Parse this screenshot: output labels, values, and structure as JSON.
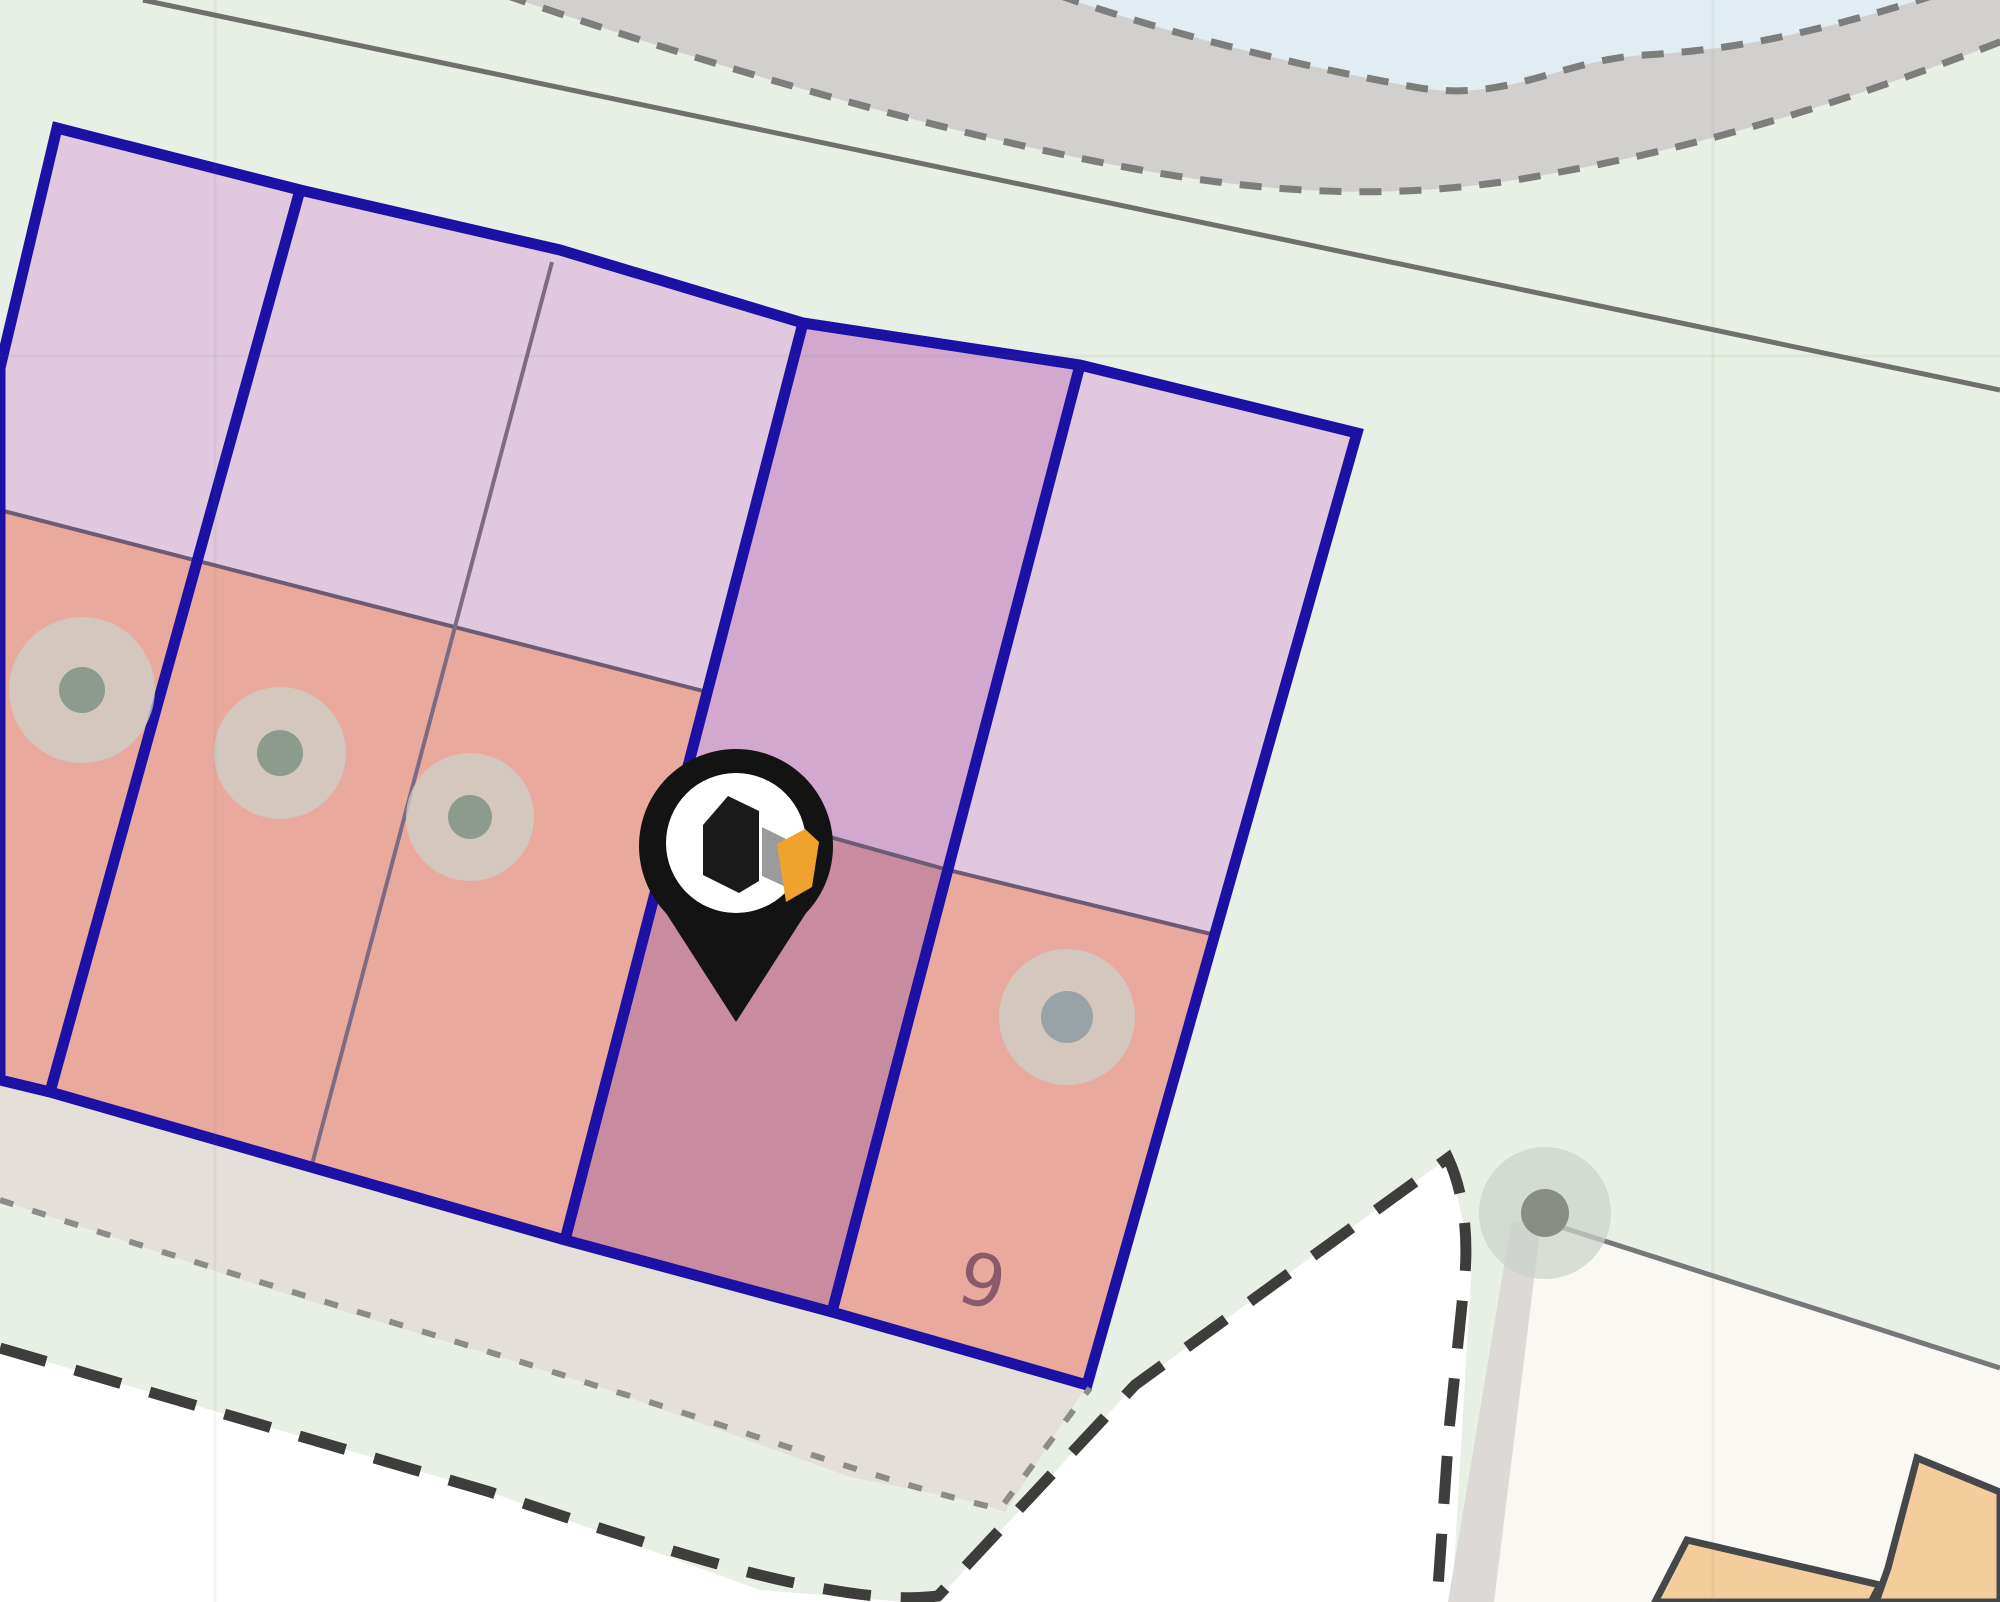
{
  "map": {
    "parcel_number_label": "9",
    "marker": {
      "icon": "location-pin-icon",
      "logo_icon": "house-cube-logo-icon"
    },
    "visible_features": {
      "parcel_strip_count": 5,
      "tree_symbol_count": 5,
      "building_count": 2
    }
  },
  "palette": {
    "green_bg": "#e8efe4",
    "water": "#e1edf2",
    "shore": "#d2d0cf",
    "shore_dash": "#7d7d7b",
    "boundary": "#6f706e",
    "white_area": "#ffffff",
    "road": "#e5dfda",
    "fine_dot": "#8b8b89",
    "bold_dash": "#3d3d3b",
    "neighbor": "#faf8f2",
    "driveway": "#dcd9d6",
    "neighbor_line": "#77787a",
    "building": "#f4cd9c",
    "building_line": "#46474a",
    "navy": "#1c10a5",
    "lavender": "#e0c9de",
    "purple": "#d2a8ce",
    "salmon": "#e9aa9d",
    "mauve": "#c98ba0",
    "division": "#6e5a73",
    "subdiv": "#7d6a84",
    "canopy": "rgba(203,210,202,0.72)",
    "tree_dot_green": "#8d9a8e",
    "tree_dot_gray": "#99a2a6",
    "tree_dot_big": "#888d86",
    "label": "#8a5a68",
    "pin_black": "#131313",
    "pin_white": "#ffffff",
    "logo_black": "#1a1a1a",
    "logo_gray": "#9b9b9b",
    "logo_orange": "#efa32d",
    "seam": "rgba(90,110,90,0.07)"
  }
}
